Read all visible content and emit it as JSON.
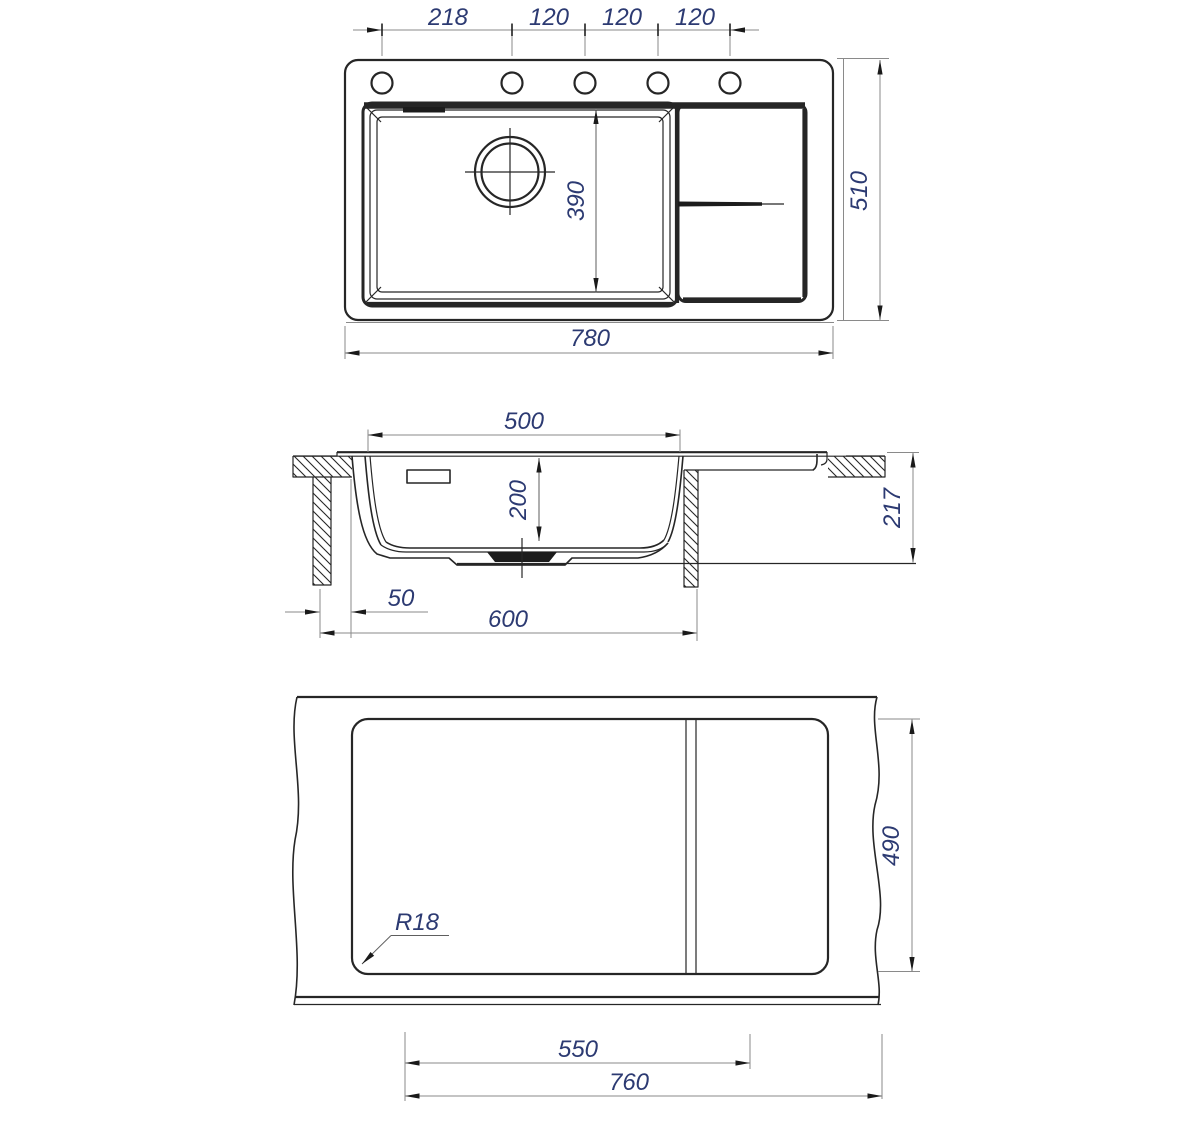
{
  "colors": {
    "line": "#262626",
    "dim-line": "#8a8a8a",
    "dim-text": "#2c3a72",
    "arrow": "#1a1a1a",
    "background": "#ffffff"
  },
  "views": {
    "top": {
      "dims": {
        "spacing": [
          "218",
          "120",
          "120",
          "120"
        ],
        "depth": "510",
        "width": "780",
        "bowl_inner": "390"
      }
    },
    "section": {
      "dims": {
        "bowl_width": "500",
        "bowl_depth": "200",
        "height": "217",
        "edge_offset": "50",
        "cabinet_width": "600"
      }
    },
    "cutout": {
      "dims": {
        "depth": "490",
        "corner_radius": "R18",
        "bowl_zone": "550",
        "width": "760"
      }
    }
  }
}
